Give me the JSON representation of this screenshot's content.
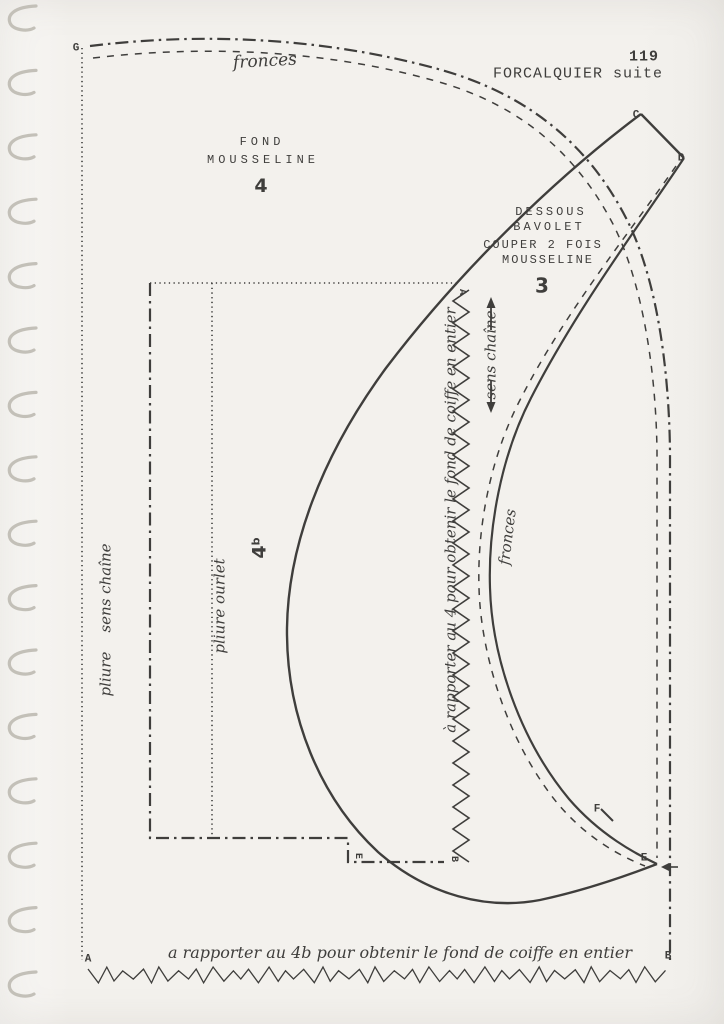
{
  "page": {
    "number": "119",
    "title": "FORCALQUIER suite"
  },
  "pieces": {
    "fond": {
      "label_line1": "FOND",
      "label_line2": "MOUSSELINE",
      "number": "4"
    },
    "bavolet": {
      "label_line1": "DESSOUS",
      "label_line2": "BAVOLET",
      "label_line3": "COUPER 2 FOIS",
      "label_line4": "MOUSSELINE",
      "number": "3"
    },
    "fond_b": {
      "number": "4",
      "sup": "b"
    }
  },
  "annotations": {
    "fronces_top": "fronces",
    "fronces_curve": "fronces",
    "sens_chaine": "sens chaîne",
    "pliure_sens_chaine": "pliure    sens chaîne",
    "pliure_ourlet": "pliure ourlet",
    "rapporter_4": "à rapporter au 4 pour obtenir le fond de coiffe en entier",
    "rapporter_4b": "a rapporter au 4b pour obtenir le fond de coiffe en entier"
  },
  "markers": {
    "G": "G",
    "A": "A",
    "B": "B",
    "C": "C",
    "D": "D",
    "E": "E",
    "F": "F",
    "zigzag_top": "A",
    "zigzag_bottom": "B",
    "corner_4b": "E"
  },
  "colors": {
    "paper": "#f3f1ed",
    "ink": "#3f3e3c",
    "binding": "#c3c0b8"
  }
}
